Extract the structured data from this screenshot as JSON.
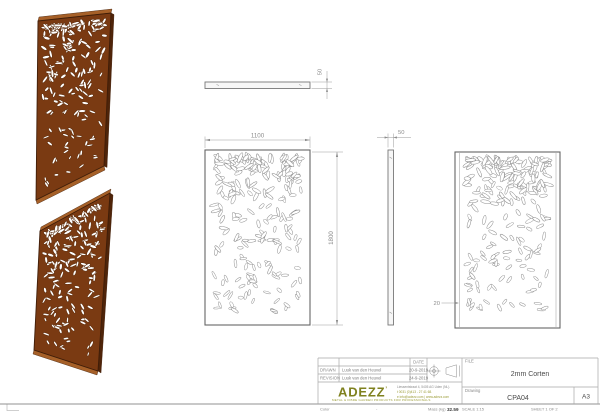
{
  "colors": {
    "corten": "#7a3a12",
    "corten_light": "#a66028",
    "corten_dark": "#4f2409",
    "corten_outline": "#3f1d08",
    "hole_fill": "#ffffff",
    "hole_stroke_iso": "#5a2d0e",
    "hole_stroke_line": "#8f8f8f",
    "outline": "#666666",
    "dim_line": "#9a9a9a",
    "dim_text": "#8c8c8c",
    "logo_olive": "#7f811f",
    "frame_line": "#a8a8a8"
  },
  "views": {
    "top_bar": {
      "thickness_label": "50"
    },
    "front": {
      "width_label": "1100",
      "height_label": "1800"
    },
    "side": {
      "thickness_label": "50"
    },
    "detail": {
      "flange_label": "20"
    }
  },
  "pattern": {
    "count_front": 215,
    "count_iso": 185,
    "seeds": [
      11,
      22,
      33,
      44
    ]
  },
  "title_block": {
    "header_date": "DATE",
    "rows": [
      {
        "label": "DRAWN",
        "name": "Luuk van den Heuvel",
        "date": "20-9-2019"
      },
      {
        "label": "REVISION",
        "name": "Luuk van den Heuvel",
        "date": "24-9-2019"
      }
    ],
    "file_label": "FILE",
    "file_value": "2mm Corten",
    "drawing_label": "Drawing",
    "drawing_value": "CPA04",
    "sheet_size": "A3",
    "scale": "SCALE 1:15",
    "sheet": "SHEET 1 OF 2",
    "logo": {
      "text": "ADEZZ",
      "mark": "’",
      "tagline": "METAL & FIBRE GARDEN PRODUCTS FOR PROFESSIONALS"
    },
    "address": {
      "line1": "Liessentstraat 4, 5405 AG Uden (NL).",
      "line2": "t 0031 (0)413 - 27 41 68.",
      "line3": "e info@adezz.com | www.adezz.com"
    }
  },
  "footer": {
    "color_label": "Color",
    "color_value": "-",
    "mass_label": "Mass (kg)",
    "mass_value": "32.59"
  }
}
